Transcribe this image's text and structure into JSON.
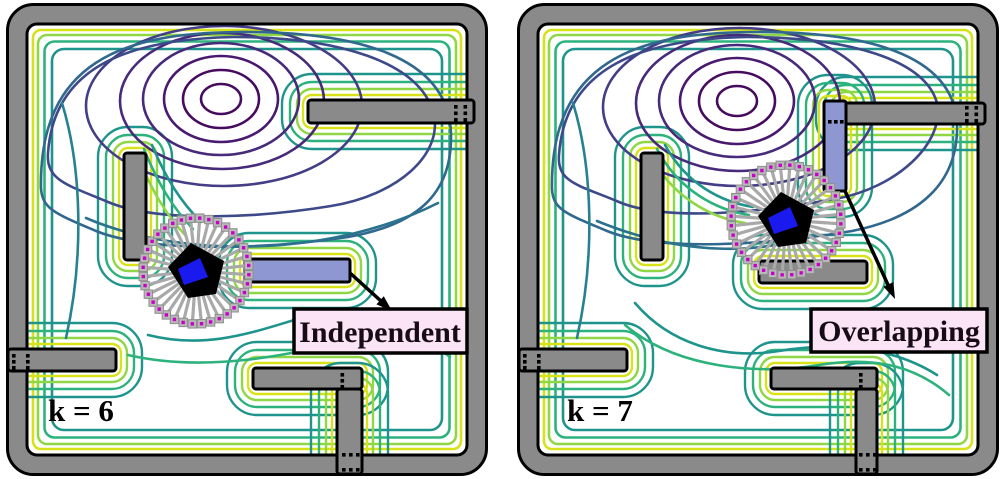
{
  "figure": {
    "panels": [
      {
        "k_label": "k = 6",
        "annotation_label": "Independent"
      },
      {
        "k_label": "k = 7",
        "annotation_label": "Overlapping"
      }
    ],
    "robot": {
      "ray_count": 36
    },
    "colors": {
      "wall_gray": "#8a8a8a",
      "outline_black": "#000000",
      "new_obstacle_blue": "#8e97d1",
      "robot_body_black": "#000000",
      "robot_heading_blue": "#1a1aee",
      "ray_gray": "#a9a9a9",
      "sensor_square_gray": "#b9b9b9",
      "sensor_square_border": "#8f8f8f",
      "sensor_dot_magenta": "#c800c8",
      "label_bg_pink": "#fbe4f5",
      "contour_viridis": [
        "#470b5e",
        "#48196e",
        "#472a7a",
        "#433e85",
        "#3e4989",
        "#31688e",
        "#2c728e",
        "#26828e",
        "#1f948c",
        "#2db27d",
        "#52c569",
        "#8fd744",
        "#d8e219"
      ]
    }
  }
}
